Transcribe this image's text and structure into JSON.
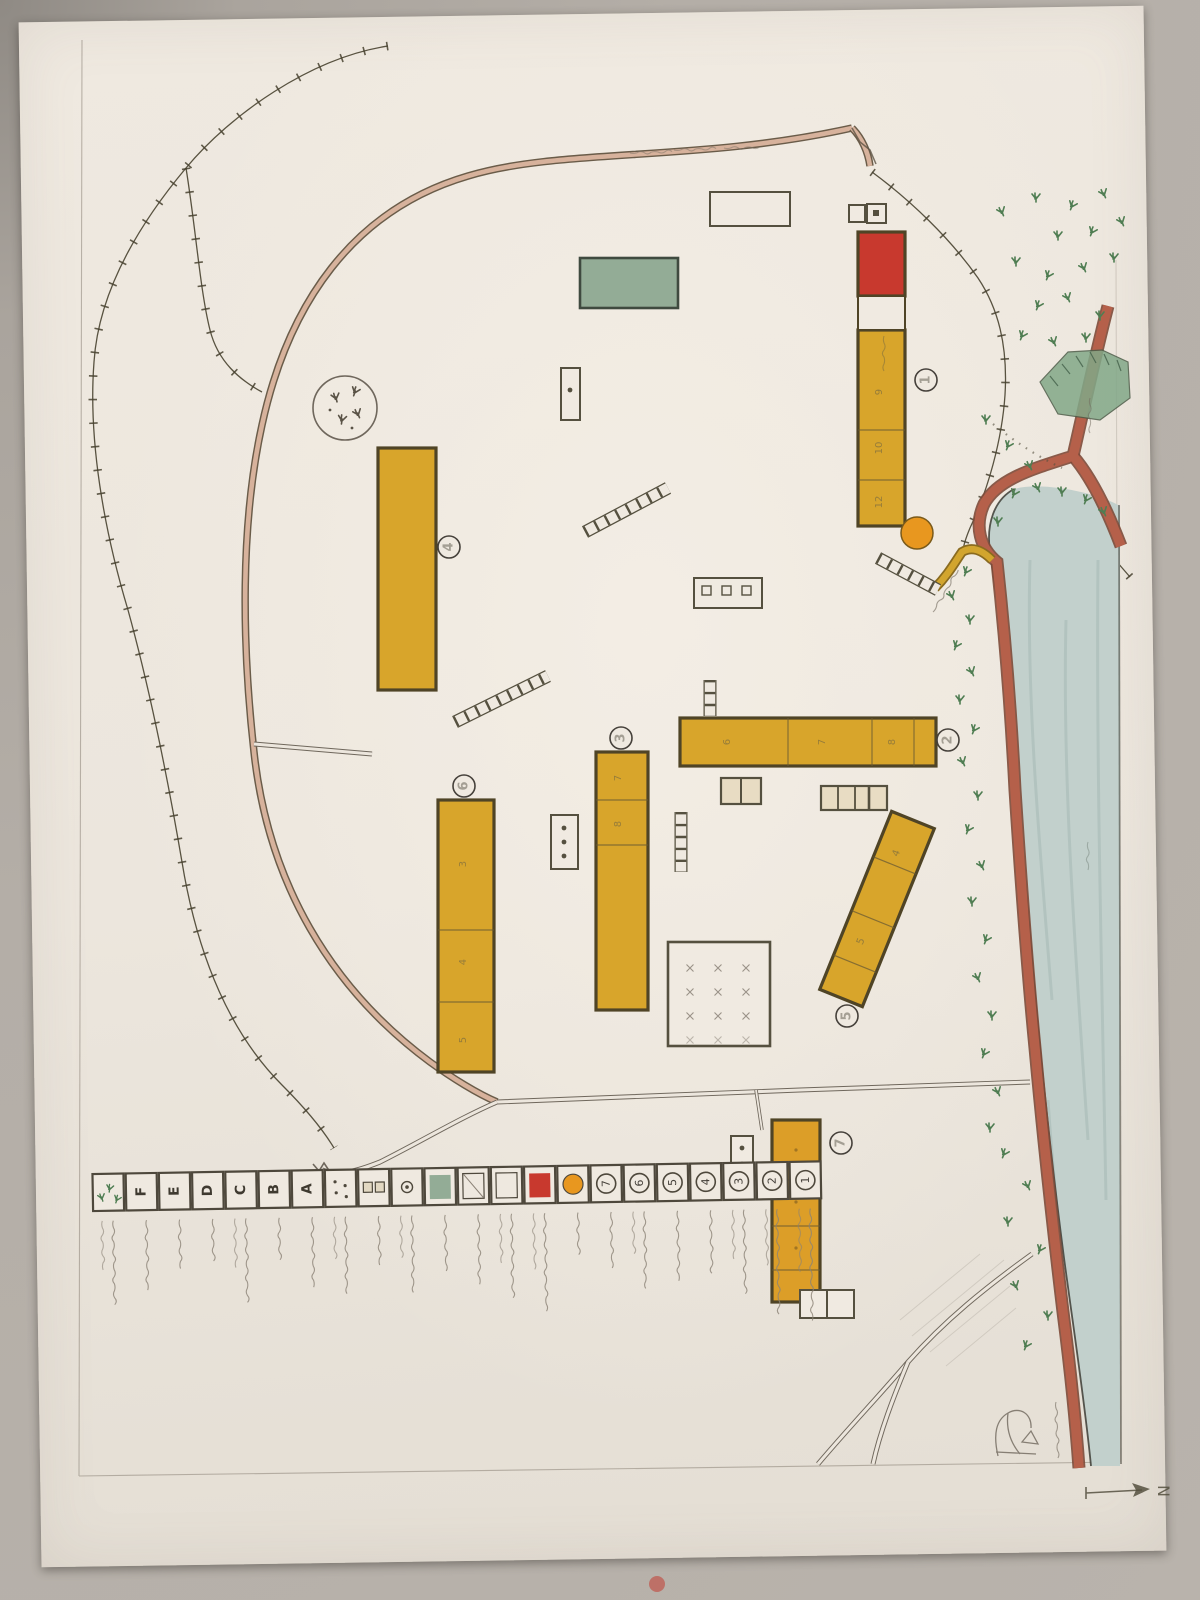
{
  "photo": {
    "background_color": "#b4aea7",
    "paper_color": "#ece6dd",
    "stain_color": "#c23a30"
  },
  "map": {
    "title": "ನಮ್ಮ ಶಾಲಾ ಆವರಣ",
    "north_label": "N",
    "colors": {
      "building_fill": "#d8a52b",
      "building_outline": "#4f4426",
      "red_block": "#c8392e",
      "green_plot": "#93ac96",
      "water": "#c2d0cc",
      "road": "#b5604a",
      "compound_wall": "#d7b29c",
      "well": "#e8971f",
      "crops": "#4f7d52"
    },
    "buildings": [
      {
        "label": "1"
      },
      {
        "label": "2"
      },
      {
        "label": "3"
      },
      {
        "label": "4"
      },
      {
        "label": "5"
      },
      {
        "label": "6"
      },
      {
        "label": "7"
      }
    ],
    "rooms": {
      "b1": [
        "9",
        "10",
        "12"
      ],
      "b2": [
        "6",
        "7",
        "8"
      ],
      "b3": [
        "7",
        "8"
      ],
      "b5": [
        "4",
        "5"
      ],
      "b6": [
        "3",
        "4",
        "5"
      ]
    },
    "annotations": {
      "rooms_word": "ಕೊಠಡಿ",
      "footpath": "ಕಾಲು ದಾರಿ",
      "hill": "ಗುಡ್ಡ",
      "lake": "ಕೆರೆ",
      "stream": "ಹಳ್ಳ"
    }
  },
  "legend": {
    "items": [
      {
        "symbol": "1",
        "type": "circled",
        "desc": "ಹಳೆಯ ಶಾಲಾ ಕಟ್ಟಡ"
      },
      {
        "symbol": "2",
        "type": "circled",
        "desc": "ಹೊಸ ಶಾಲಾ ಕಟ್ಟಡ"
      },
      {
        "symbol": "3",
        "type": "circled",
        "desc": "ಕಚೇರಿ ಕೊಠಡಿ"
      },
      {
        "symbol": "4",
        "type": "circled",
        "desc": "ಸಭಾ ಭವನ"
      },
      {
        "symbol": "5",
        "type": "circled",
        "desc": "ಗ್ರಂಥಾಲಯ"
      },
      {
        "symbol": "6",
        "type": "circled",
        "desc": "ಅಡುಗೆ ಕೋಣೆ"
      },
      {
        "symbol": "7",
        "type": "circled",
        "desc": "ಶೌಚಾಲಯ"
      },
      {
        "symbol": "",
        "type": "well",
        "desc": "ಬಾವಿ"
      },
      {
        "symbol": "",
        "type": "red_square",
        "desc": "ನ�ೀರಿನ ತೊಟ್ಟಿ"
      },
      {
        "symbol": "",
        "type": "white_square",
        "desc": "ಖಾಲಿ ನಿವೇಶನ"
      },
      {
        "symbol": "",
        "type": "diag_square",
        "desc": "ಆಟದ ಮೈದಾನ"
      },
      {
        "symbol": "",
        "type": "green_square",
        "desc": "ಕೈ ತೋಟ"
      },
      {
        "symbol": "",
        "type": "circle_dot",
        "desc": "ಧ್ವಜ ಸ್ತಂಭ"
      },
      {
        "symbol": "",
        "type": "two_squares",
        "desc": "ಕಟ್ಟೆ"
      },
      {
        "symbol": "",
        "type": "dots",
        "desc": "ಕಲ್ಲು ಹಾಸು"
      },
      {
        "symbol": "A",
        "type": "letter",
        "desc": "ಆಟದ ಅಂಗಳ"
      },
      {
        "symbol": "B",
        "type": "letter",
        "desc": "ದಾರಿ"
      },
      {
        "symbol": "C",
        "type": "letter",
        "desc": "ಮೆಟ್ಟಿಲುಗಳು"
      },
      {
        "symbol": "D",
        "type": "letter",
        "desc": "ಕೆರೆ"
      },
      {
        "symbol": "E",
        "type": "letter",
        "desc": "ಗುಡ್ಡ"
      },
      {
        "symbol": "F",
        "type": "letter",
        "desc": "ಹೊಲ ಗದ್ದೆ"
      },
      {
        "symbol": "",
        "type": "crops",
        "desc": "ಬೆಳೆ ಪ್ರದೇಶ"
      }
    ]
  }
}
